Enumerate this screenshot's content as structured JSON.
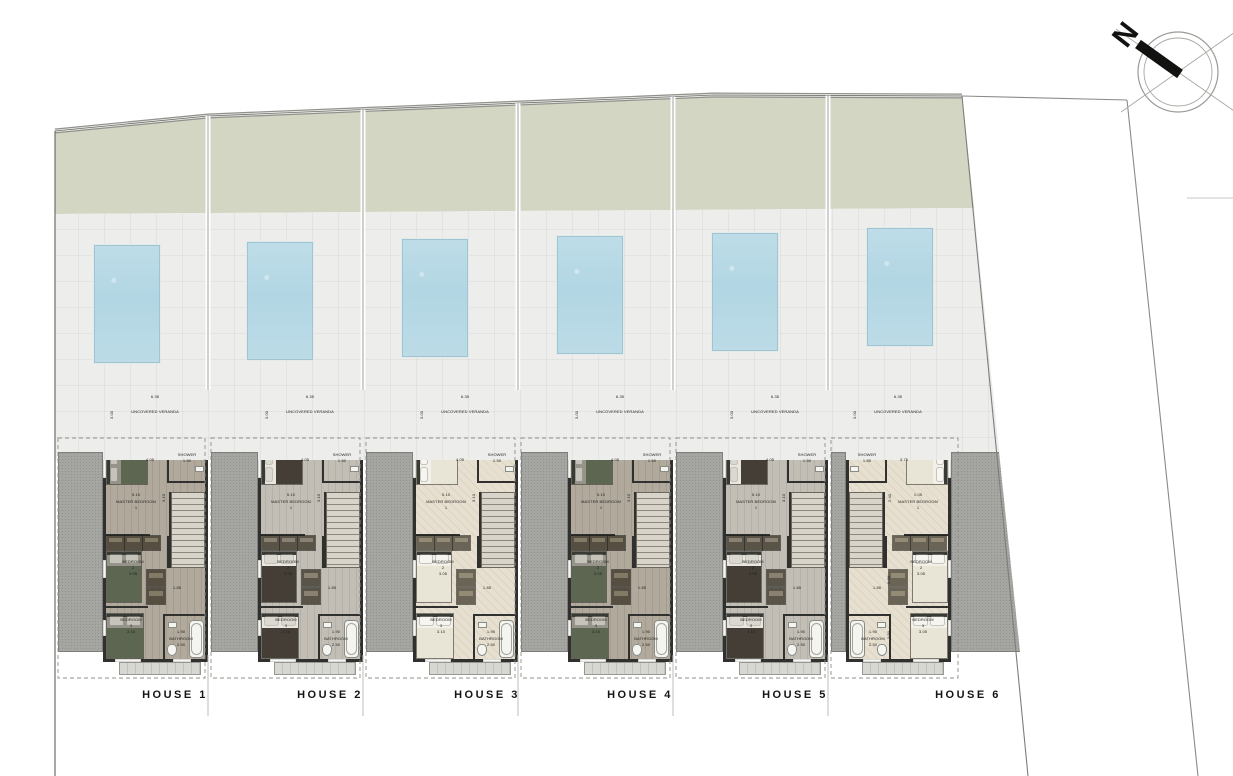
{
  "north_label": "N",
  "veranda_label": "UNCOVERED VERANDA",
  "houses": [
    {
      "label": "HOUSE 1",
      "palette": "dark",
      "mirrored": false,
      "veranda": {
        "label": "UNCOVERED VERANDA",
        "width": "6.35",
        "depth": "3.00"
      },
      "master": {
        "name": "MASTER BEDROOM",
        "number": "1",
        "dim_a": "4.05",
        "dim_b": "5.10",
        "dim_side": "3.10"
      },
      "bedroom2": {
        "name": "BEDROOM",
        "number": "2",
        "dim": "3.05"
      },
      "bedroom3": {
        "name": "BEDROOM",
        "number": "3",
        "dim": "3.10"
      },
      "bathroom": {
        "name": "BATHROOM",
        "dim_a": "1.90",
        "dim_b": "2.50"
      },
      "shower": {
        "name": "SHOWER",
        "dim": "1.50"
      },
      "hall_dim": "1.85"
    },
    {
      "label": "HOUSE 2",
      "palette": "brown",
      "mirrored": false,
      "veranda": {
        "label": "UNCOVERED VERANDA",
        "width": "6.35",
        "depth": "3.00"
      },
      "master": {
        "name": "MASTER BEDROOM",
        "number": "1",
        "dim_a": "4.05",
        "dim_b": "5.10",
        "dim_side": "3.10"
      },
      "bedroom2": {
        "name": "BEDROOM",
        "number": "2",
        "dim": "3.05"
      },
      "bedroom3": {
        "name": "BEDROOM",
        "number": "3",
        "dim": "3.10"
      },
      "bathroom": {
        "name": "BATHROOM",
        "dim_a": "1.90",
        "dim_b": "2.50"
      },
      "shower": {
        "name": "SHOWER",
        "dim": "1.50"
      },
      "hall_dim": "1.85"
    },
    {
      "label": "HOUSE 3",
      "palette": "light",
      "mirrored": false,
      "veranda": {
        "label": "UNCOVERED VERANDA",
        "width": "6.35",
        "depth": "3.00"
      },
      "master": {
        "name": "MASTER BEDROOM",
        "number": "1",
        "dim_a": "4.05",
        "dim_b": "5.10",
        "dim_side": "3.10"
      },
      "bedroom2": {
        "name": "BEDROOM",
        "number": "2",
        "dim": "3.05"
      },
      "bedroom3": {
        "name": "BEDROOM",
        "number": "3",
        "dim": "3.10"
      },
      "bathroom": {
        "name": "BATHROOM",
        "dim_a": "1.90",
        "dim_b": "2.50"
      },
      "shower": {
        "name": "SHOWER",
        "dim": "1.50"
      },
      "hall_dim": "1.85"
    },
    {
      "label": "HOUSE 4",
      "palette": "dark",
      "mirrored": false,
      "veranda": {
        "label": "UNCOVERED VERANDA",
        "width": "6.35",
        "depth": "3.00"
      },
      "master": {
        "name": "MASTER BEDROOM",
        "number": "1",
        "dim_a": "4.05",
        "dim_b": "5.10",
        "dim_side": "3.10"
      },
      "bedroom2": {
        "name": "BEDROOM",
        "number": "2",
        "dim": "3.05"
      },
      "bedroom3": {
        "name": "BEDROOM",
        "number": "3",
        "dim": "3.10"
      },
      "bathroom": {
        "name": "BATHROOM",
        "dim_a": "1.90",
        "dim_b": "2.50"
      },
      "shower": {
        "name": "SHOWER",
        "dim": "1.50"
      },
      "hall_dim": "1.85"
    },
    {
      "label": "HOUSE 5",
      "palette": "brown",
      "mirrored": false,
      "veranda": {
        "label": "UNCOVERED VERANDA",
        "width": "6.35",
        "depth": "3.00"
      },
      "master": {
        "name": "MASTER BEDROOM",
        "number": "1",
        "dim_a": "4.05",
        "dim_b": "5.10",
        "dim_side": "3.10"
      },
      "bedroom2": {
        "name": "BEDROOM",
        "number": "2",
        "dim": "3.05"
      },
      "bedroom3": {
        "name": "BEDROOM",
        "number": "3",
        "dim": "3.10"
      },
      "bathroom": {
        "name": "BATHROOM",
        "dim_a": "1.90",
        "dim_b": "2.50"
      },
      "shower": {
        "name": "SHOWER",
        "dim": "1.50"
      },
      "hall_dim": "1.85"
    },
    {
      "label": "HOUSE 6",
      "palette": "light",
      "mirrored": true,
      "veranda": {
        "label": "UNCOVERED VERANDA",
        "width": "6.35",
        "depth": "3.00"
      },
      "master": {
        "name": "MASTER BEDROOM",
        "number": "1",
        "dim_a": "3.75",
        "dim_b": "1.05",
        "dim_side": "2.40"
      },
      "bedroom2": {
        "name": "BEDROOM",
        "number": "2",
        "dim": "3.05",
        "dim_side": "3.30"
      },
      "bedroom3": {
        "name": "BEDROOM",
        "number": "3",
        "dim": "3.05",
        "dim_side": "3.90"
      },
      "bathroom": {
        "name": "BATHROOM",
        "dim_a": "1.90",
        "dim_b": "2.50"
      },
      "shower": {
        "name": "SHOWER",
        "dim": "1.85"
      },
      "hall_dim": "1.85"
    }
  ],
  "colors": {
    "lawn": "#d2d6c3",
    "patio": "#ededec",
    "pool": "#b5d8e4",
    "side_yard": "#a5a5a2",
    "wall": "#30302e"
  }
}
